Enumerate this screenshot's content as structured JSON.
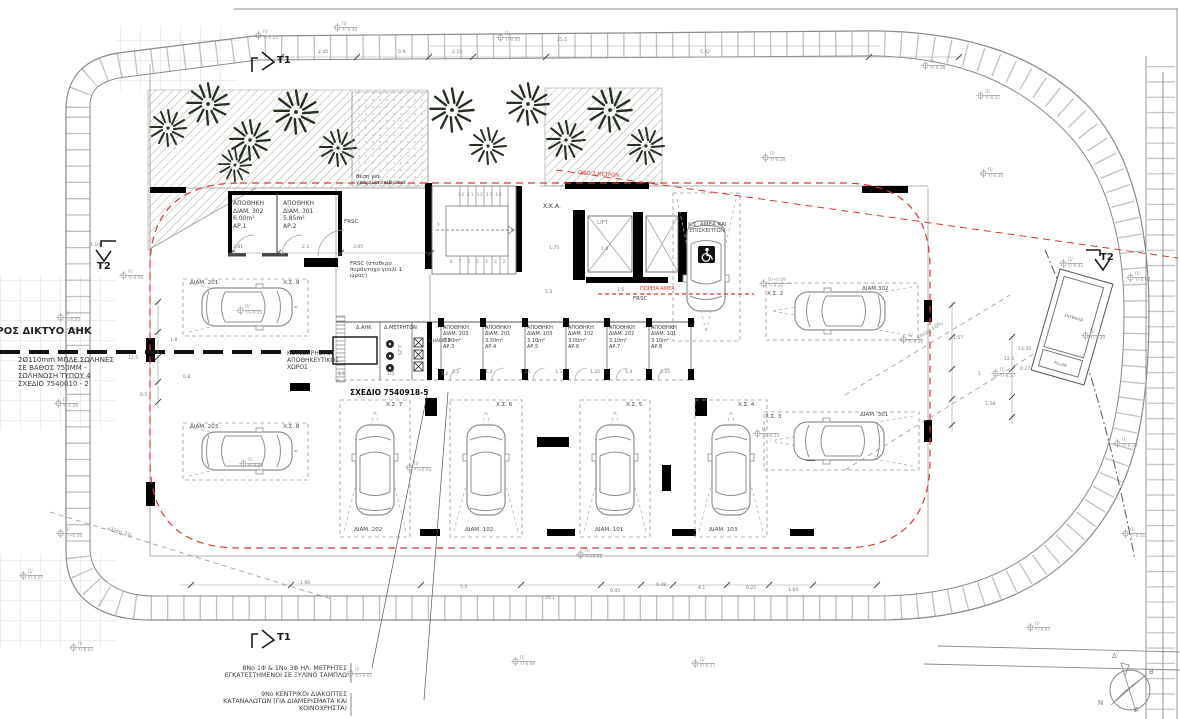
{
  "colors": {
    "red_accent": "#d93a31",
    "wall": "#000000",
    "linework": "#8a8a8a",
    "tree": "#26301f",
    "hatch": "#9fae9a"
  },
  "notes": {
    "ahk_network": "ΠΡΟΣ ΔΙΚΤΥΟ ΑΗΚ",
    "pipes": [
      "2Ø110mm ΜΠΛΕ ΣΩΛΗΝΕΣ",
      "ΣΕ ΒΑΘΟΣ 750ΜΜ -",
      "ΣΩΛΗΝΩΣΗ ΤΥΠΟΥ 4",
      "ΣΧΕΔΙΟ 7540010 - 2"
    ],
    "mailboxes": [
      "θέση για",
      "γραμματοκιβώτια"
    ],
    "frsc": "FRSC",
    "frsc_note": "FRSC (σταθερό πυράντοχο γυαλί 1 ώρας)",
    "sxedio": "ΣΧΕΔΙΟ 7540918-5",
    "koinoxristos": [
      "ΚΟΙΝΟΧΡΗΣΤΟΣ",
      "ΑΠΟΘΗΚΕΥΤΙΚΟΣ",
      "ΧΩΡΟΣ"
    ],
    "orio": "ΟΡΙΟ 3 ΜΕΤΡΩΝ",
    "poreia": "ΠΟΡΕΙΑ ΑΜΕΑ",
    "meters_note": [
      "8Νο 1Φ & 1Νο 3Φ ΗΛ. ΜΕΤΡΗΤΕΣ",
      "ΕΓΚΑΤΕΣΤΗΜΕΝΟΙ ΣΕ ΞΥΛΙΝΟ ΤΑΜΠΛΩ"
    ],
    "switches_note": [
      "9Νο ΚΕΝΤΡΙΚΟΙ ΔΙΑΚΟΠΤΕΣ",
      "ΚΑΤΑΝΑΛΩΤΩΝ (ΓΙΑ ΔΙΑΜΕΡΙΣΜΑΤΑ ΚΑΙ",
      "ΚΟΙΝΟΧΡΗΣΤΑ)"
    ]
  },
  "rooms": {
    "dahk": "Δ.ΑΗΚ",
    "dmetriton": "Δ.ΜΕΤΡΗΤΩΝ",
    "dilektr": "Δ.ΗΛΕΚΤΡ",
    "xka": "Χ.Κ.Α.",
    "lift": "LIFT",
    "amea": [
      "Χ.Σ. ΑΜΕΑ ΚΑΙ",
      "ΕΠΙΣΚΕΠΤΩΝ"
    ],
    "skyvala": "ΣΚΥΒΑΛΑ",
    "pillar": "PILLAR"
  },
  "sections": {
    "t1": "T1",
    "t2": "T2"
  },
  "slopes": {
    "s2": "κλίση 2%",
    "s10": "κλίση 10%"
  },
  "stairs": {
    "r1": "10 11 12 13 14",
    "r2": "8 7 6 5 4 3 2",
    "r3": "9"
  },
  "compass": {
    "delta": "Δ",
    "beta": "Β",
    "nu": "Ν",
    "alpha": "Α"
  },
  "storage_units": [
    {
      "x": 233,
      "y": 200,
      "w": 46,
      "fs": 6,
      "name": "ΑΠΟΘΗΚΗ",
      "unit": "ΔΙΑΜ. 302",
      "area": "6.00m²",
      "ap": "ΑΡ.1"
    },
    {
      "x": 283,
      "y": 200,
      "w": 46,
      "fs": 6,
      "name": "ΑΠΟΘΗΚΗ",
      "unit": "ΔΙΑΜ. 301",
      "area": "5.85m²",
      "ap": "ΑΡ.2"
    },
    {
      "x": 443,
      "y": 325,
      "w": 40,
      "fs": 5,
      "name": "ΑΠΟΘΗΚΗ",
      "unit": "ΔΙΑΜ. 203",
      "area": "3.30m²",
      "ap": "ΑΡ.3"
    },
    {
      "x": 485,
      "y": 325,
      "w": 40,
      "fs": 5,
      "name": "ΑΠΟΘΗΚΗ",
      "unit": "ΔΙΑΜ. 201",
      "area": "3.30m²",
      "ap": "ΑΡ.4"
    },
    {
      "x": 527,
      "y": 325,
      "w": 40,
      "fs": 5,
      "name": "ΑΠΟΘΗΚΗ",
      "unit": "ΔΙΑΜ. 103",
      "area": "3.10m²",
      "ap": "ΑΡ.5"
    },
    {
      "x": 568,
      "y": 325,
      "w": 40,
      "fs": 5,
      "name": "ΑΠΟΘΗΚΗ",
      "unit": "ΔΙΑΜ. 102",
      "area": "3.00m²",
      "ap": "ΑΡ.6"
    },
    {
      "x": 609,
      "y": 325,
      "w": 40,
      "fs": 5,
      "name": "ΑΠΟΘΗΚΗ",
      "unit": "ΔΙΑΜ. 202",
      "area": "3.10m²",
      "ap": "ΑΡ.7"
    },
    {
      "x": 651,
      "y": 325,
      "w": 40,
      "fs": 5,
      "name": "ΑΠΟΘΗΚΗ",
      "unit": "ΔΙΑΜ. 101",
      "area": "3.10m²",
      "ap": "ΑΡ.8"
    }
  ],
  "plan_labels": [
    {
      "x": 190,
      "y": 280,
      "t": "ΔΙΑΜ. 201"
    },
    {
      "x": 283,
      "y": 280,
      "t": "Χ.Σ. 9"
    },
    {
      "x": 190,
      "y": 424,
      "t": "ΔΙΑΜ. 203"
    },
    {
      "x": 283,
      "y": 424,
      "t": "Χ.Σ. 8"
    },
    {
      "x": 862,
      "y": 286,
      "t": "ΔΙΑΜ.302"
    },
    {
      "x": 767,
      "y": 291,
      "t": "Χ.Σ. 2"
    },
    {
      "x": 860,
      "y": 412,
      "t": "ΔΙΑΜ. 301"
    },
    {
      "x": 765,
      "y": 414,
      "t": "Χ.Σ. 3"
    },
    {
      "x": 386,
      "y": 402,
      "t": "Χ.Σ. 7"
    },
    {
      "x": 354,
      "y": 527,
      "t": "ΔΙΑΜ. 202"
    },
    {
      "x": 496,
      "y": 402,
      "t": "Χ.Σ. 6"
    },
    {
      "x": 465,
      "y": 527,
      "t": "ΔΙΑΜ. 102"
    },
    {
      "x": 626,
      "y": 402,
      "t": "Χ.Σ. 5"
    },
    {
      "x": 595,
      "y": 527,
      "t": "ΔΙΑΜ. 101"
    },
    {
      "x": 738,
      "y": 402,
      "t": "Χ.Σ. 4"
    },
    {
      "x": 709,
      "y": 527,
      "t": "ΔΙΑΜ. 103"
    }
  ],
  "markers": [
    {
      "x": 263,
      "y": 30,
      "l1": "Π/",
      "l2": "Υ/-0.41"
    },
    {
      "x": 342,
      "y": 22,
      "l1": "Π/",
      "l2": "Υ/-0.44"
    },
    {
      "x": 505,
      "y": 32,
      "l1": "Π/",
      "l2": "Υ/-0.45"
    },
    {
      "x": 770,
      "y": 152,
      "l1": "Π/",
      "l2": "Υ/-0.28"
    },
    {
      "x": 930,
      "y": 60,
      "l1": "Π/",
      "l2": "Υ/-0.38"
    },
    {
      "x": 985,
      "y": 90,
      "l1": "Π/",
      "l2": "Υ/-0.51"
    },
    {
      "x": 988,
      "y": 168,
      "l1": "Π/",
      "l2": "Υ/-0.26"
    },
    {
      "x": 1068,
      "y": 258,
      "l1": "Π/",
      "l2": "Υ/-0.42"
    },
    {
      "x": 1135,
      "y": 272,
      "l1": "Π/",
      "l2": "Υ/-0.63"
    },
    {
      "x": 1090,
      "y": 330,
      "l1": "Π/",
      "l2": "Υ/-0.39"
    },
    {
      "x": 908,
      "y": 334,
      "l1": "Π/",
      "l2": "Υ/-0.26"
    },
    {
      "x": 1000,
      "y": 368,
      "l1": "Π/",
      "l2": "Υ/-0.27"
    },
    {
      "x": 1122,
      "y": 438,
      "l1": "Π/",
      "l2": "Υ/-0.29"
    },
    {
      "x": 1130,
      "y": 528,
      "l1": "Π/",
      "l2": "Υ/-0.51"
    },
    {
      "x": 1035,
      "y": 622,
      "l1": "Π/",
      "l2": "Υ/-0.67"
    },
    {
      "x": 65,
      "y": 312,
      "l1": "Π/",
      "l2": "Υ/-0.05"
    },
    {
      "x": 128,
      "y": 270,
      "l1": "Π/",
      "l2": "Υ/-0.04"
    },
    {
      "x": 63,
      "y": 398,
      "l1": "Π/",
      "l2": "Υ/-0.04"
    },
    {
      "x": 65,
      "y": 528,
      "l1": "Π/",
      "l2": "Υ/+0.00"
    },
    {
      "x": 28,
      "y": 570,
      "l1": "Π/",
      "l2": "Υ/-0.07"
    },
    {
      "x": 78,
      "y": 642,
      "l1": "Π/",
      "l2": "Υ/-0.02"
    },
    {
      "x": 355,
      "y": 668,
      "l1": "Π/",
      "l2": "Υ/+0.61"
    },
    {
      "x": 414,
      "y": 462,
      "l1": "Π/",
      "l2": "Υ/+0.02"
    },
    {
      "x": 585,
      "y": 549,
      "l1": "Π/",
      "l2": "Υ/+0.09"
    },
    {
      "x": 245,
      "y": 305,
      "l1": "Π/",
      "l2": "Υ/+0.05"
    },
    {
      "x": 248,
      "y": 458,
      "l1": "Π/",
      "l2": "Υ/-0.09"
    },
    {
      "x": 768,
      "y": 278,
      "l1": "Π/+0.09",
      "l2": "Υ/-0.22"
    },
    {
      "x": 762,
      "y": 428,
      "l1": "Π/",
      "l2": "Υ/+0.13"
    },
    {
      "x": 520,
      "y": 656,
      "l1": "Π/",
      "l2": "Υ/-0.60"
    },
    {
      "x": 700,
      "y": 658,
      "l1": "Π/",
      "l2": "Υ/-0.17"
    }
  ],
  "dims": [
    {
      "x": 318,
      "y": 50,
      "t": "2.45"
    },
    {
      "x": 398,
      "y": 50,
      "t": "0.9"
    },
    {
      "x": 452,
      "y": 50,
      "t": "2.15"
    },
    {
      "x": 700,
      "y": 50,
      "t": "5.42"
    },
    {
      "x": 557,
      "y": 38,
      "t": "25.1"
    },
    {
      "x": 90,
      "y": 243,
      "t": "1.10"
    },
    {
      "x": 233,
      "y": 245,
      "t": "2.81"
    },
    {
      "x": 302,
      "y": 245,
      "t": "2.1"
    },
    {
      "x": 353,
      "y": 245,
      "t": "3.05"
    },
    {
      "x": 549,
      "y": 246,
      "t": "1.75"
    },
    {
      "x": 601,
      "y": 247,
      "t": "1.8"
    },
    {
      "x": 617,
      "y": 288,
      "t": "1.5"
    },
    {
      "x": 545,
      "y": 290,
      "t": "1.3"
    },
    {
      "x": 170,
      "y": 338,
      "t": "1.8"
    },
    {
      "x": 128,
      "y": 356,
      "t": "12.5"
    },
    {
      "x": 183,
      "y": 375,
      "t": "0.8"
    },
    {
      "x": 140,
      "y": 393,
      "t": "0.5"
    },
    {
      "x": 452,
      "y": 370,
      "t": "1.2"
    },
    {
      "x": 485,
      "y": 370,
      "t": "1.3"
    },
    {
      "x": 520,
      "y": 370,
      "t": "1.25"
    },
    {
      "x": 555,
      "y": 370,
      "t": "1.3"
    },
    {
      "x": 590,
      "y": 370,
      "t": "1.25"
    },
    {
      "x": 625,
      "y": 370,
      "t": "1.3"
    },
    {
      "x": 660,
      "y": 370,
      "t": "1.25"
    },
    {
      "x": 338,
      "y": 372,
      "t": "1.1"
    },
    {
      "x": 387,
      "y": 372,
      "t": "1.5"
    },
    {
      "x": 441,
      "y": 372,
      "t": "1.2"
    },
    {
      "x": 401,
      "y": 345,
      "t": "2.25",
      "rot": 90
    },
    {
      "x": 953,
      "y": 336,
      "t": "1.57"
    },
    {
      "x": 978,
      "y": 372,
      "t": "1"
    },
    {
      "x": 985,
      "y": 402,
      "t": "1.58"
    },
    {
      "x": 1004,
      "y": 357,
      "t": "12.5"
    },
    {
      "x": 1018,
      "y": 347,
      "t": "13.35"
    },
    {
      "x": 1020,
      "y": 367,
      "t": "0.27"
    },
    {
      "x": 300,
      "y": 581,
      "t": "1.06"
    },
    {
      "x": 460,
      "y": 585,
      "t": "5.5"
    },
    {
      "x": 545,
      "y": 596,
      "t": "25.1"
    },
    {
      "x": 610,
      "y": 589,
      "t": "0.45"
    },
    {
      "x": 656,
      "y": 583,
      "t": "0.48"
    },
    {
      "x": 698,
      "y": 586,
      "t": "9.1"
    },
    {
      "x": 746,
      "y": 586,
      "t": "0.25"
    },
    {
      "x": 788,
      "y": 588,
      "t": "1.64"
    }
  ]
}
